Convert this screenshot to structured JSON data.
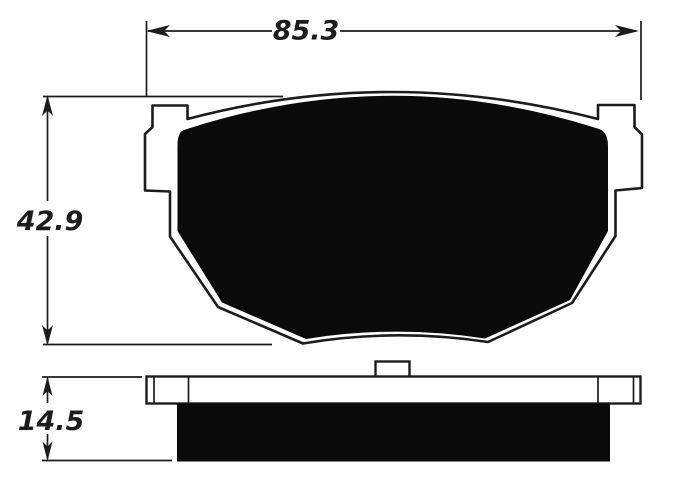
{
  "dimensions": {
    "width": {
      "value": "85.3"
    },
    "height": {
      "value": "42.9"
    },
    "thickness": {
      "value": "14.5"
    }
  },
  "colors": {
    "ink": "#1c1c1c",
    "pad_fill": "#0a0a0a",
    "background": "#ffffff"
  }
}
